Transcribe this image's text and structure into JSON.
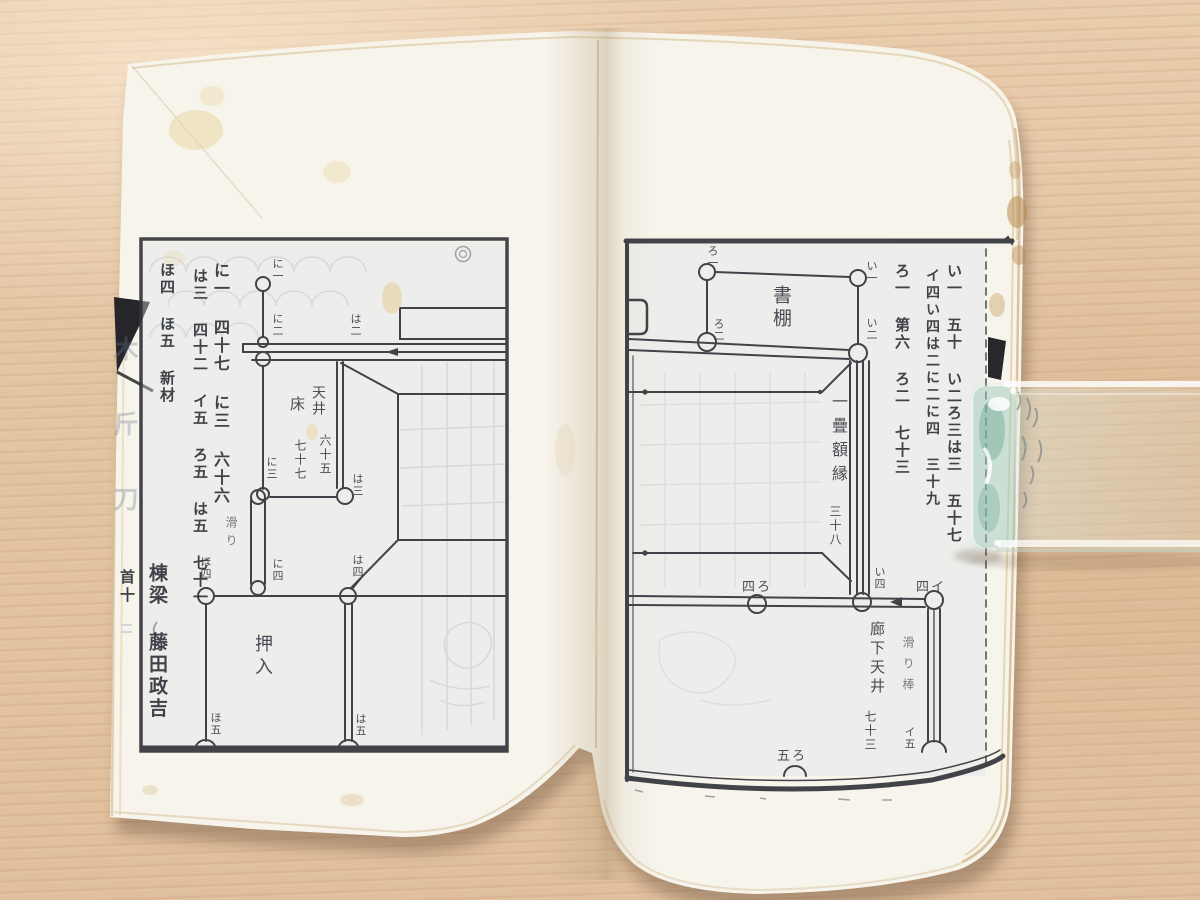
{
  "photo_subject": "antique Japanese carpentry book opened on wooden table with glass paperweight",
  "colors": {
    "table_wood": "#e5c7a7",
    "wood_grain": "#c28a68",
    "paper": "#f7f4ec",
    "page_edge": "#e2cfa4",
    "ink": "#33353c",
    "handwriting_ink": "#23262e",
    "show_through_blue": "#7388a8",
    "cover_black": "#26262a",
    "glass_aqua": "#9cc8b7",
    "stain_brown": "#b98a50"
  },
  "left_page": {
    "labels": [
      {
        "n": "margin-col-1",
        "t": "に一 四十七 に三 六十六",
        "x": 212,
        "y": 262,
        "s": 16,
        "o": "v",
        "ls": 2,
        "cls": "hand"
      },
      {
        "n": "margin-col-2",
        "t": "は三 四十二 イ五 ろ五 は五 七十一",
        "x": 192,
        "y": 268,
        "s": 15,
        "o": "v",
        "ls": 2,
        "cls": "hand"
      },
      {
        "n": "margin-col-3",
        "t": "ほ四 ほ五 新材",
        "x": 159,
        "y": 262,
        "s": 15,
        "o": "v",
        "ls": 2,
        "cls": "hand"
      },
      {
        "n": "carpenter-signature",
        "t": "棟梁 藤田政吉",
        "x": 147,
        "y": 563,
        "s": 19,
        "o": "v",
        "ls": 3,
        "cls": "hand"
      },
      {
        "n": "page-mark",
        "t": "首十",
        "x": 119,
        "y": 569,
        "s": 15,
        "o": "v",
        "ls": 3,
        "cls": "hand"
      },
      {
        "n": "fold-title-ghost",
        "t": "木斤刀",
        "x": 112,
        "y": 336,
        "s": 25,
        "o": "v",
        "ls": 50,
        "cls": "ghost"
      },
      {
        "n": "label-ni-1",
        "t": "に一",
        "x": 272,
        "y": 258,
        "s": 11,
        "o": "v",
        "ls": 1,
        "cls": "print"
      },
      {
        "n": "label-ni-2",
        "t": "に二",
        "x": 272,
        "y": 313,
        "s": 11,
        "o": "v",
        "ls": 1,
        "cls": "print"
      },
      {
        "n": "label-ha-2",
        "t": "は二",
        "x": 350,
        "y": 313,
        "s": 11,
        "o": "v",
        "ls": 1,
        "cls": "print"
      },
      {
        "n": "label-toko",
        "t": "床",
        "x": 289,
        "y": 396,
        "s": 15,
        "o": "v",
        "ls": 0,
        "cls": "print"
      },
      {
        "n": "label-tenjo",
        "t": "天井",
        "x": 311,
        "y": 385,
        "s": 14,
        "o": "v",
        "ls": 2,
        "cls": "print"
      },
      {
        "n": "label-rokujugo",
        "t": "六十五",
        "x": 319,
        "y": 434,
        "s": 12,
        "o": "v",
        "ls": 2,
        "cls": "print"
      },
      {
        "n": "label-nanajunana",
        "t": "七十七",
        "x": 294,
        "y": 439,
        "s": 12,
        "o": "v",
        "ls": 2,
        "cls": "print"
      },
      {
        "n": "label-ni-3",
        "t": "に三",
        "x": 266,
        "y": 456,
        "s": 11,
        "o": "v",
        "ls": 1,
        "cls": "print"
      },
      {
        "n": "label-ha-3",
        "t": "は三",
        "x": 352,
        "y": 473,
        "s": 11,
        "o": "v",
        "ls": 1,
        "cls": "print"
      },
      {
        "n": "label-suberi",
        "t": "滑り",
        "x": 225,
        "y": 516,
        "s": 12,
        "o": "v",
        "ls": 6,
        "cls": "print-light"
      },
      {
        "n": "label-ni-4",
        "t": "に四",
        "x": 272,
        "y": 558,
        "s": 11,
        "o": "v",
        "ls": 1,
        "cls": "print"
      },
      {
        "n": "label-ho-4",
        "t": "ほ四",
        "x": 200,
        "y": 556,
        "s": 11,
        "o": "v",
        "ls": 1,
        "cls": "print"
      },
      {
        "n": "label-ha-4",
        "t": "は四",
        "x": 352,
        "y": 554,
        "s": 11,
        "o": "v",
        "ls": 1,
        "cls": "print"
      },
      {
        "n": "label-oshiire",
        "t": "押入",
        "x": 253,
        "y": 634,
        "s": 18,
        "o": "v",
        "ls": 5,
        "cls": "print"
      },
      {
        "n": "label-ho-5",
        "t": "ほ五",
        "x": 210,
        "y": 712,
        "s": 11,
        "o": "v",
        "ls": 1,
        "cls": "print"
      },
      {
        "n": "label-ha-5",
        "t": "は五",
        "x": 355,
        "y": 713,
        "s": 11,
        "o": "v",
        "ls": 1,
        "cls": "print"
      }
    ]
  },
  "right_page": {
    "labels": [
      {
        "n": "margin-col-1",
        "t": "い一 五十 い二ろ三は三 五十七",
        "x": 946,
        "y": 263,
        "s": 15,
        "o": "v",
        "ls": 2,
        "cls": "hand"
      },
      {
        "n": "margin-col-2",
        "t": "イ四い四は二に二に四 三十九",
        "x": 925,
        "y": 268,
        "s": 14,
        "o": "v",
        "ls": 3,
        "cls": "hand"
      },
      {
        "n": "margin-col-3",
        "t": "ろ一 第六 ろ二 七十三",
        "x": 894,
        "y": 263,
        "s": 15,
        "o": "v",
        "ls": 2,
        "cls": "hand"
      },
      {
        "n": "label-ro-1",
        "t": "ろ一",
        "x": 707,
        "y": 245,
        "s": 11,
        "o": "v",
        "ls": 1,
        "cls": "print"
      },
      {
        "n": "label-i-1",
        "t": "い一",
        "x": 866,
        "y": 260,
        "s": 11,
        "o": "v",
        "ls": 1,
        "cls": "print"
      },
      {
        "n": "label-shodana",
        "t": "書棚",
        "x": 771,
        "y": 285,
        "s": 19,
        "o": "v",
        "ls": 4,
        "cls": "print"
      },
      {
        "n": "label-ro-2",
        "t": "ろ二",
        "x": 713,
        "y": 318,
        "s": 11,
        "o": "v",
        "ls": 1,
        "cls": "print"
      },
      {
        "n": "label-i-2",
        "t": "い二",
        "x": 866,
        "y": 317,
        "s": 11,
        "o": "v",
        "ls": 1,
        "cls": "print"
      },
      {
        "n": "label-gakubuchi",
        "t": "一疊額縁",
        "x": 830,
        "y": 393,
        "s": 16,
        "o": "v",
        "ls": 8,
        "cls": "print"
      },
      {
        "n": "label-sanjuhachi",
        "t": "三十八",
        "x": 829,
        "y": 505,
        "s": 12,
        "o": "v",
        "ls": 2,
        "cls": "print"
      },
      {
        "n": "label-4-ro",
        "t": "四ろ",
        "x": 742,
        "y": 581,
        "s": 13,
        "o": "h",
        "ls": 2,
        "cls": "print"
      },
      {
        "n": "label-i-4",
        "t": "い四",
        "x": 874,
        "y": 566,
        "s": 11,
        "o": "v",
        "ls": 1,
        "cls": "print"
      },
      {
        "n": "label-4-i",
        "t": "四イ",
        "x": 916,
        "y": 581,
        "s": 13,
        "o": "h",
        "ls": 2,
        "cls": "print"
      },
      {
        "n": "label-roka-tenjo",
        "t": "廊下天井",
        "x": 869,
        "y": 621,
        "s": 15,
        "o": "v",
        "ls": 4,
        "cls": "print"
      },
      {
        "n": "label-nanajusan",
        "t": "七十三",
        "x": 864,
        "y": 710,
        "s": 12,
        "o": "v",
        "ls": 2,
        "cls": "print"
      },
      {
        "n": "label-suberi-bo",
        "t": "滑り棒",
        "x": 902,
        "y": 636,
        "s": 12,
        "o": "v",
        "ls": 9,
        "cls": "print-light"
      },
      {
        "n": "label-i-5",
        "t": "イ五",
        "x": 904,
        "y": 726,
        "s": 11,
        "o": "v",
        "ls": 1,
        "cls": "print"
      },
      {
        "n": "label-5-ro",
        "t": "五ろ",
        "x": 777,
        "y": 750,
        "s": 13,
        "o": "h",
        "ls": 2,
        "cls": "print"
      }
    ]
  }
}
